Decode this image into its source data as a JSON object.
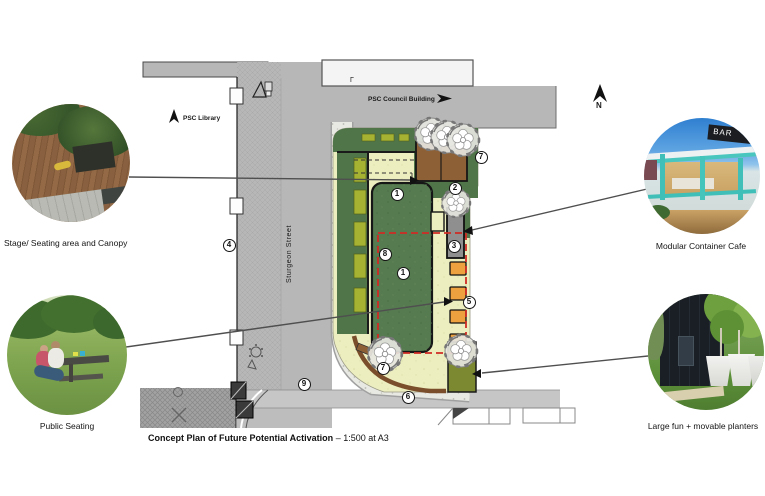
{
  "caption": {
    "title": "Concept Plan of Future Potential Activation",
    "scale": "– 1:500 at A3"
  },
  "plan": {
    "labels": {
      "library": "PSC Library",
      "council": "PSC Council Building",
      "street": "Sturgeon Street",
      "north": "N",
      "building_mark": "Γ"
    },
    "markers": [
      {
        "label": "1",
        "x": 397,
        "y": 194
      },
      {
        "label": "2",
        "x": 455,
        "y": 188
      },
      {
        "label": "3",
        "x": 454,
        "y": 246
      },
      {
        "label": "4",
        "x": 229,
        "y": 245
      },
      {
        "label": "5",
        "x": 469,
        "y": 302
      },
      {
        "label": "6",
        "x": 408,
        "y": 397
      },
      {
        "label": "7",
        "x": 481,
        "y": 157
      },
      {
        "label": "7",
        "x": 383,
        "y": 368
      },
      {
        "label": "8",
        "x": 385,
        "y": 254
      },
      {
        "label": "1",
        "x": 403,
        "y": 273
      },
      {
        "label": "9",
        "x": 304,
        "y": 384
      }
    ]
  },
  "callouts": {
    "stage": {
      "label": "Stage/ Seating area and Canopy"
    },
    "public_seating": {
      "label": "Public Seating"
    },
    "cafe": {
      "label": "Modular Container Cafe",
      "sign_text": "BAR"
    },
    "planters": {
      "label": "Large fun + movable planters"
    }
  },
  "colors": {
    "lawn_green": "#567b50",
    "band_green": "#4f7549",
    "cream": "#eceec0",
    "olive": "#a5b232",
    "deck_brown": "#8d6036",
    "container_gray": "#8f8f8f",
    "planter_orange": "#eda13f",
    "activation_red": "#cf2b24",
    "street_gray": "#b7b7b7",
    "olive_patch": "#7c8931"
  }
}
